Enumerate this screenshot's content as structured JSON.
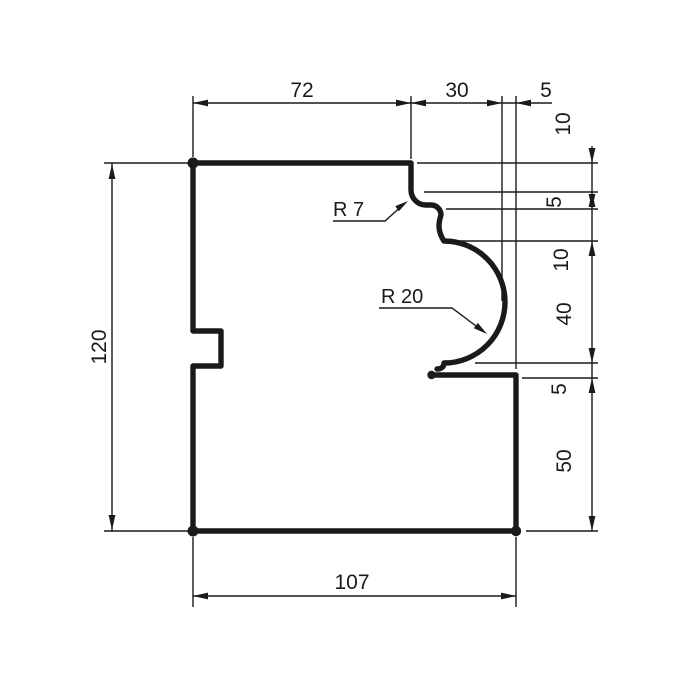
{
  "drawing": {
    "type": "technical-profile-drawing",
    "dims": {
      "top_72": "72",
      "top_30": "30",
      "top_5": "5",
      "right_10_upper": "10",
      "right_5_upper": "5",
      "right_10_lower": "10",
      "right_40": "40",
      "right_5_lower": "5",
      "right_50": "50",
      "left_120": "120",
      "bottom_107": "107"
    },
    "radius_labels": {
      "r7": "R 7",
      "r20": "R 20"
    },
    "colors": {
      "line": "#1a1a1a",
      "background": "#ffffff"
    }
  }
}
